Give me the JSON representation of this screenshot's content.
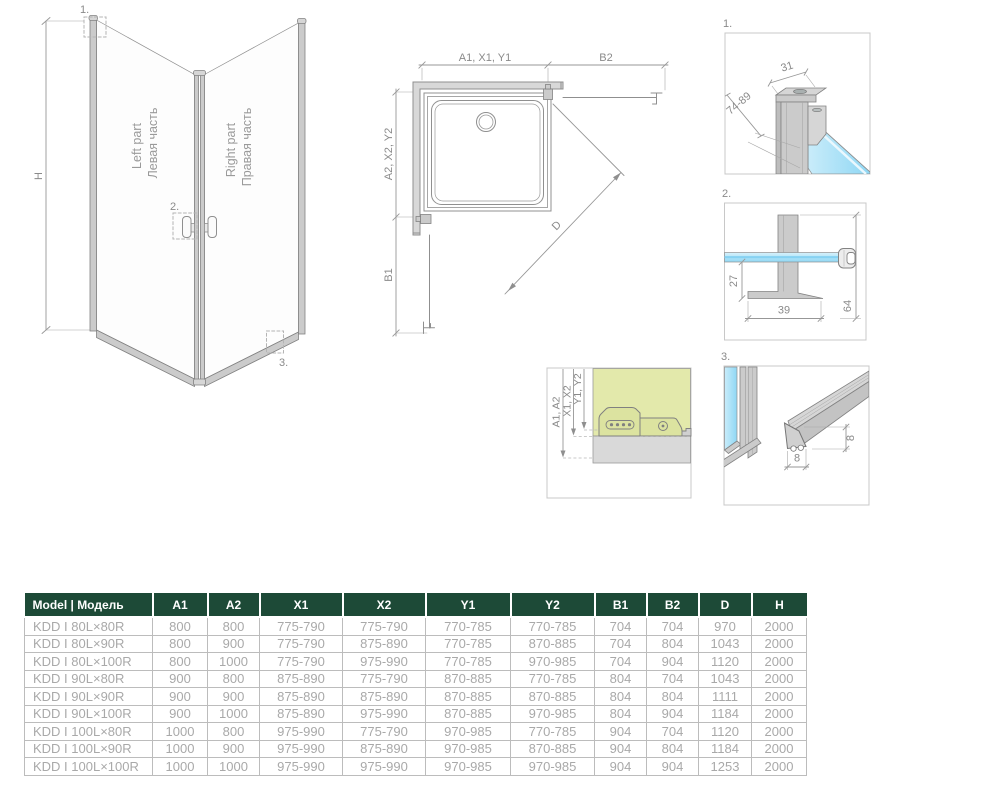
{
  "perspective": {
    "marker_1": "1.",
    "marker_2": "2.",
    "marker_3": "3.",
    "height_label": "H",
    "left_panel_line1": "Left part",
    "left_panel_line2": "Левая часть",
    "right_panel_line1": "Right part",
    "right_panel_line2": "Правая часть"
  },
  "plan": {
    "dim_top_left": "A1, X1, Y1",
    "dim_top_right": "B2",
    "dim_side_upper": "A2, X2, Y2",
    "dim_side_lower": "B1",
    "dim_diagonal": "D"
  },
  "mount_detail": {
    "dim_a": "A1, A2",
    "dim_x": "X1, X2",
    "dim_y": "Y1, Y2"
  },
  "details": {
    "d1": {
      "label": "1.",
      "dim_width": "31",
      "dim_range": "74-89"
    },
    "d2": {
      "label": "2.",
      "dim_height_inner": "27",
      "dim_width": "39",
      "dim_height_total": "64"
    },
    "d3": {
      "label": "3.",
      "dim_width": "8",
      "dim_height": "8"
    }
  },
  "table": {
    "headers": [
      "Model | Модель",
      "A1",
      "A2",
      "X1",
      "X2",
      "Y1",
      "Y2",
      "B1",
      "B2",
      "D",
      "H"
    ],
    "rows": [
      [
        "KDD I 80L×80R",
        "800",
        "800",
        "775-790",
        "775-790",
        "770-785",
        "770-785",
        "704",
        "704",
        "970",
        "2000"
      ],
      [
        "KDD I 80L×90R",
        "800",
        "900",
        "775-790",
        "875-890",
        "770-785",
        "870-885",
        "704",
        "804",
        "1043",
        "2000"
      ],
      [
        "KDD I 80L×100R",
        "800",
        "1000",
        "775-790",
        "975-990",
        "770-785",
        "970-985",
        "704",
        "904",
        "1120",
        "2000"
      ],
      [
        "KDD I 90L×80R",
        "900",
        "800",
        "875-890",
        "775-790",
        "870-885",
        "770-785",
        "804",
        "704",
        "1043",
        "2000"
      ],
      [
        "KDD I 90L×90R",
        "900",
        "900",
        "875-890",
        "875-890",
        "870-885",
        "870-885",
        "804",
        "804",
        "1111",
        "2000"
      ],
      [
        "KDD I 90L×100R",
        "900",
        "1000",
        "875-890",
        "975-990",
        "870-885",
        "970-985",
        "804",
        "904",
        "1184",
        "2000"
      ],
      [
        "KDD I 100L×80R",
        "1000",
        "800",
        "975-990",
        "775-790",
        "970-985",
        "770-785",
        "904",
        "704",
        "1120",
        "2000"
      ],
      [
        "KDD I 100L×90R",
        "1000",
        "900",
        "975-990",
        "875-890",
        "970-985",
        "870-885",
        "904",
        "804",
        "1184",
        "2000"
      ],
      [
        "KDD I 100L×100R",
        "1000",
        "1000",
        "975-990",
        "975-990",
        "970-985",
        "970-985",
        "904",
        "904",
        "1253",
        "2000"
      ]
    ]
  },
  "colors": {
    "header_green": "#1d4a37",
    "glass_blue": "#8fd7f4",
    "glass_blue_light": "#d8f2fc",
    "wall_olive": "#e3e9ab",
    "line_gray": "#8f8f8f",
    "profile_gray": "#cbcbcb"
  }
}
